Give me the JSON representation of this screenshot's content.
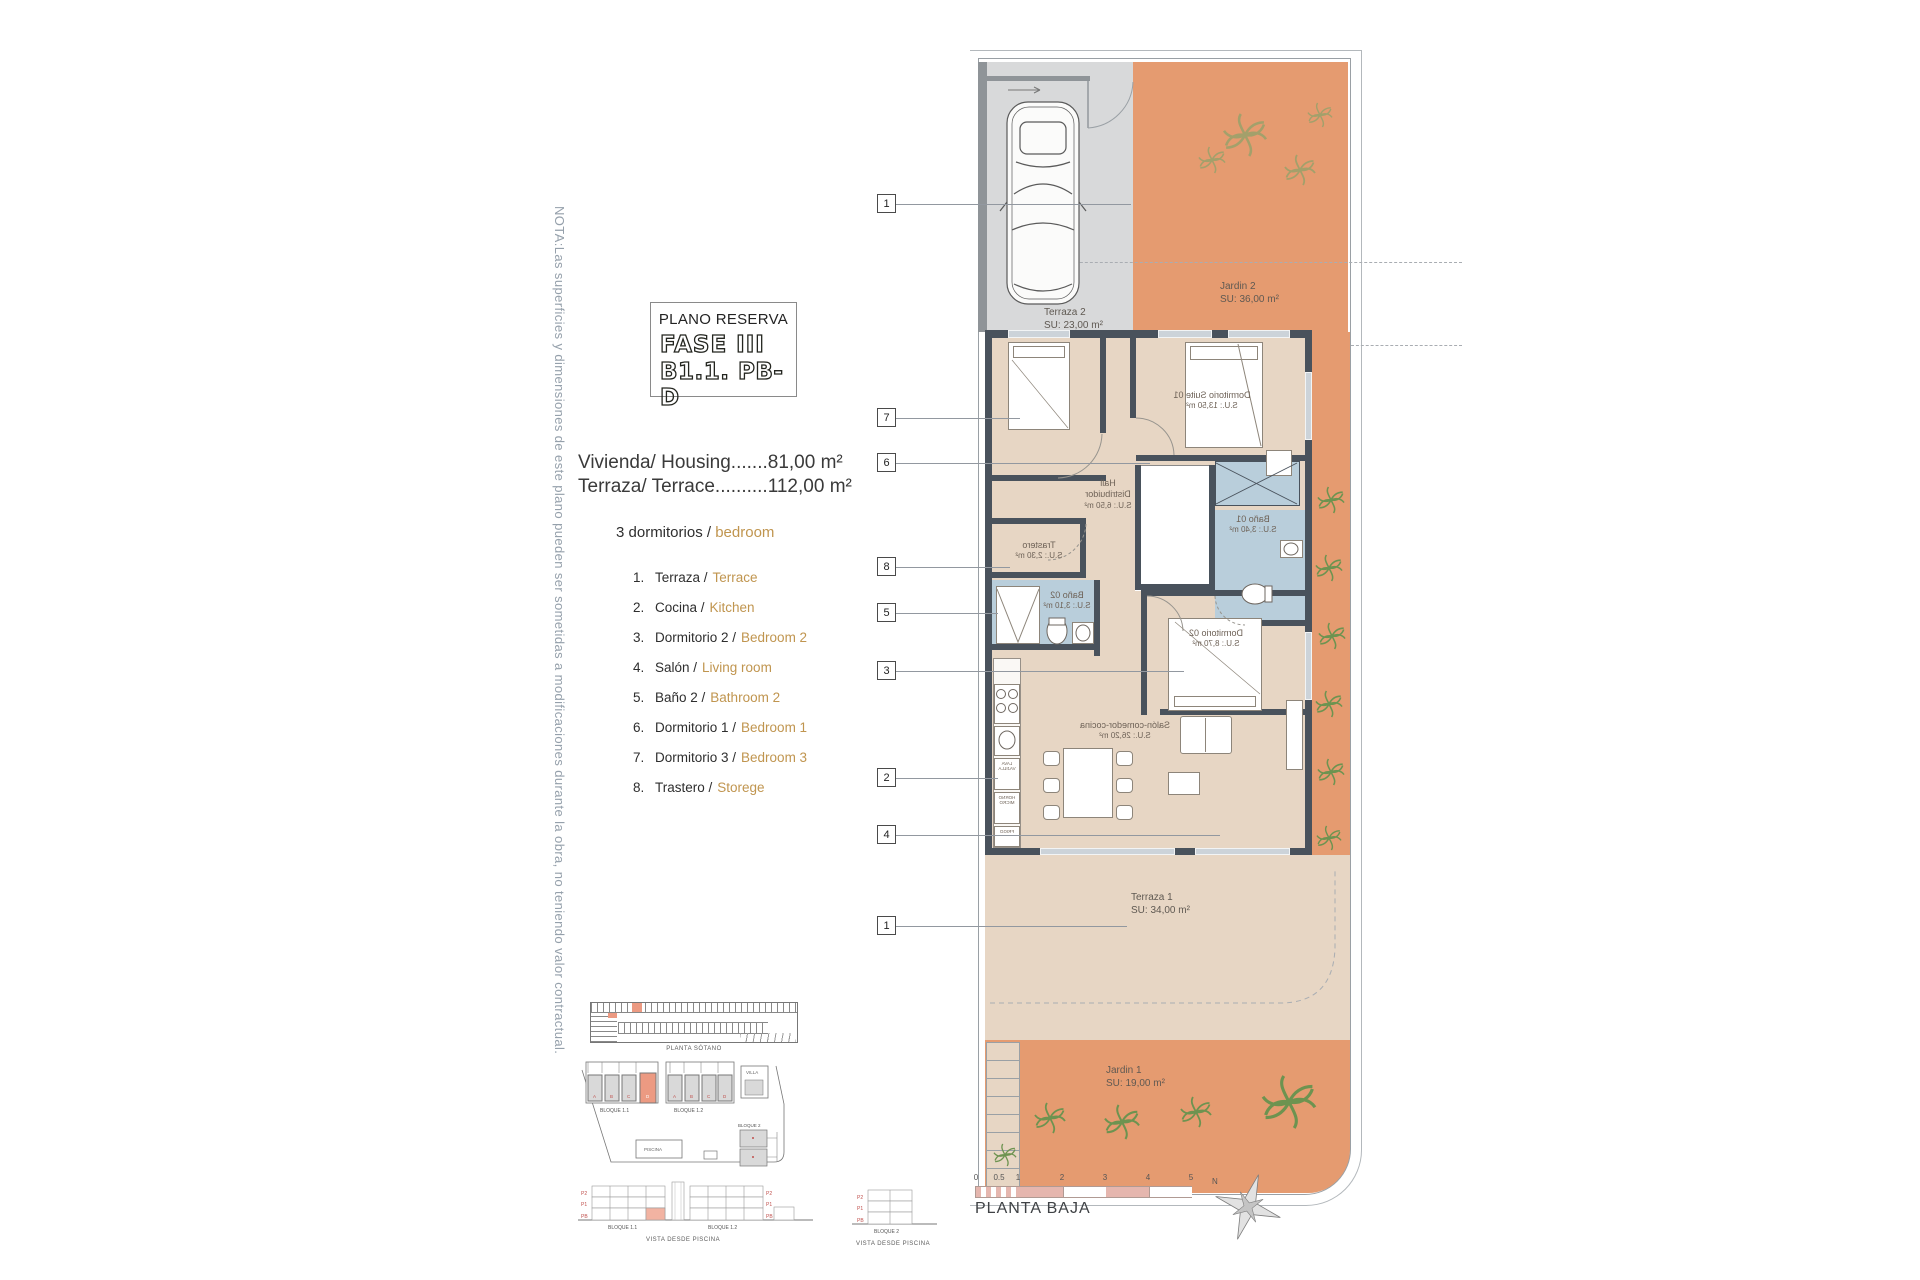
{
  "note": "NOTA:Las superficies y dimensiones de este plano pueden ser sometidas a modificaciones durante la obra, no teniendo valor contractual.",
  "title_block": {
    "subtitle": "PLANO RESERVA",
    "phase": "FASE III",
    "unit": "B1.1. PB-D"
  },
  "summary": {
    "housing": "Vivienda/ Housing.......81,00 m²",
    "terrace": "Terraza/ Terrace..........112,00 m²",
    "bedrooms_es": "3 dormitorios /",
    "bedrooms_en": "bedroom"
  },
  "legend": [
    {
      "num": "1.",
      "es": "Terraza /",
      "en": "Terrace"
    },
    {
      "num": "2.",
      "es": "Cocina /",
      "en": "Kitchen"
    },
    {
      "num": "3.",
      "es": "Dormitorio 2 /",
      "en": "Bedroom 2"
    },
    {
      "num": "4.",
      "es": "Salón /",
      "en": "Living room"
    },
    {
      "num": "5.",
      "es": "Baño 2 /",
      "en": "Bathroom 2"
    },
    {
      "num": "6.",
      "es": "Dormitorio 1 /",
      "en": "Bedroom 1"
    },
    {
      "num": "7.",
      "es": "Dormitorio 3 /",
      "en": "Bedroom 3"
    },
    {
      "num": "8.",
      "es": "Trastero /",
      "en": "Storege"
    }
  ],
  "rooms": {
    "terraza2": {
      "name": "Terraza 2",
      "area": "SU: 23,00 m²"
    },
    "jardin2": {
      "name": "Jardin 2",
      "area": "SU: 36,00 m²"
    },
    "suite": {
      "name": "Dormitorio Suite 01",
      "area": "S.U.: 13,50 m²"
    },
    "hall": {
      "l1": "Hall",
      "l2": "Distribuidor",
      "area": "S.U.: 6,50 m²"
    },
    "bano1": {
      "name": "Baño 01",
      "area": "S.U.: 3,40 m²"
    },
    "trastero": {
      "name": "Trastero",
      "area": "S.U.: 2,30 m²"
    },
    "bano2": {
      "name": "Baño 02",
      "area": "S.U.: 3,10 m²"
    },
    "dorm2": {
      "name": "Dormitorio 02",
      "area": "S.U.: 8,70 m²"
    },
    "salon": {
      "name": "Salón-comedor-cocina",
      "area": "S.U.: 26,20 m²"
    },
    "terraza1": {
      "name": "Terraza 1",
      "area": "SU: 34,00 m²"
    },
    "jardin1": {
      "name": "Jardin 1",
      "area": "SU: 19,00 m²"
    }
  },
  "kitchen": {
    "lv1": "LAVA",
    "lv2": "VAJILLA",
    "ov1": "HORNO",
    "ov2": "MICRO",
    "fr": "FRIGO"
  },
  "callouts": [
    "1",
    "7",
    "6",
    "8",
    "5",
    "3",
    "2",
    "4",
    "1"
  ],
  "scalebar": {
    "ticks": [
      "0",
      "0.5",
      "1",
      "2",
      "3",
      "4",
      "5"
    ],
    "caption": "PLANTA BAJA",
    "north": "N"
  },
  "minis": {
    "basement_caption": "PLANTA SÓTANO",
    "site": {
      "b11": "BLOQUE 1.1",
      "b12": "BLOQUE 1.2",
      "b2": "BLOQUE 2",
      "pool": "PISCINA",
      "villa": "VILLA",
      "units": [
        "A",
        "B",
        "C",
        "D"
      ]
    },
    "elev": {
      "p2": "P2",
      "p1": "P1",
      "pb": "PB",
      "view": "VISTA DESDE PISCINA"
    }
  },
  "colors": {
    "accent_orange": "#c0954f",
    "garden": "#e59b70",
    "floor": "#e7d6c4",
    "bath": "#b9cedb",
    "wall": "#49525c",
    "highlight": "#ec9a82"
  }
}
